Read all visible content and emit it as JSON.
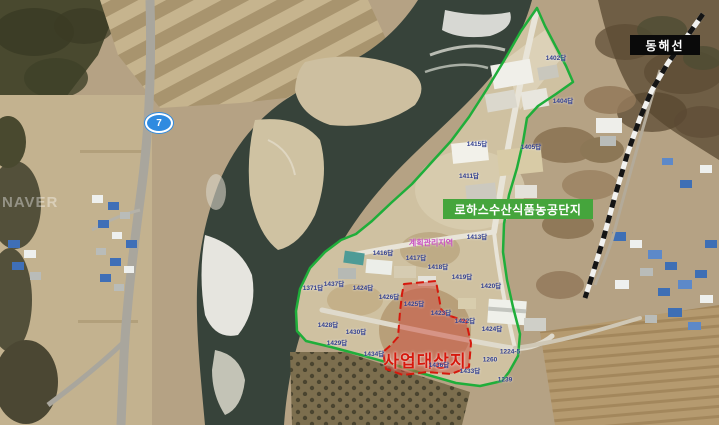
{
  "map": {
    "watermark": "NAVER",
    "route_badge": "7",
    "labels": {
      "complex": "로하스수산식품농공단지",
      "railway": "동해선",
      "project_site": "사업대상지",
      "zoning": "계획관리지역"
    },
    "colors": {
      "boundary_green": "#1fae3a",
      "complex_label_bg": "#45a53c",
      "railway_label_bg": "#0a0a0a",
      "project_site_red": "#d6180c",
      "lot_label_navy": "#33408f",
      "zoning_magenta": "#c84fc0",
      "route_badge_blue": "#2f8be0"
    },
    "lot_labels": [
      {
        "text": "1402답",
        "x": 556,
        "y": 57
      },
      {
        "text": "1404답",
        "x": 563,
        "y": 100
      },
      {
        "text": "1415답",
        "x": 477,
        "y": 143
      },
      {
        "text": "1405답",
        "x": 531,
        "y": 146
      },
      {
        "text": "1411답",
        "x": 469,
        "y": 175
      },
      {
        "text": "1413답",
        "x": 477,
        "y": 236
      },
      {
        "text": "1416답",
        "x": 383,
        "y": 252
      },
      {
        "text": "1417답",
        "x": 416,
        "y": 257
      },
      {
        "text": "1418답",
        "x": 438,
        "y": 266
      },
      {
        "text": "1419답",
        "x": 462,
        "y": 276
      },
      {
        "text": "1437답",
        "x": 334,
        "y": 283
      },
      {
        "text": "1371답",
        "x": 313,
        "y": 287
      },
      {
        "text": "1424답",
        "x": 363,
        "y": 287
      },
      {
        "text": "1426답",
        "x": 389,
        "y": 296
      },
      {
        "text": "1425답",
        "x": 414,
        "y": 303
      },
      {
        "text": "1423답",
        "x": 441,
        "y": 312
      },
      {
        "text": "1422답",
        "x": 465,
        "y": 320
      },
      {
        "text": "1424답",
        "x": 492,
        "y": 328
      },
      {
        "text": "1420답",
        "x": 491,
        "y": 285
      },
      {
        "text": "1428답",
        "x": 328,
        "y": 324
      },
      {
        "text": "1430답",
        "x": 356,
        "y": 331
      },
      {
        "text": "1429답",
        "x": 337,
        "y": 342
      },
      {
        "text": "1434답",
        "x": 374,
        "y": 353
      },
      {
        "text": "1436답",
        "x": 439,
        "y": 364
      },
      {
        "text": "1433답",
        "x": 470,
        "y": 370
      },
      {
        "text": "1224-5",
        "x": 510,
        "y": 352
      },
      {
        "text": "1260",
        "x": 490,
        "y": 360
      },
      {
        "text": "1239",
        "x": 505,
        "y": 380
      }
    ]
  }
}
